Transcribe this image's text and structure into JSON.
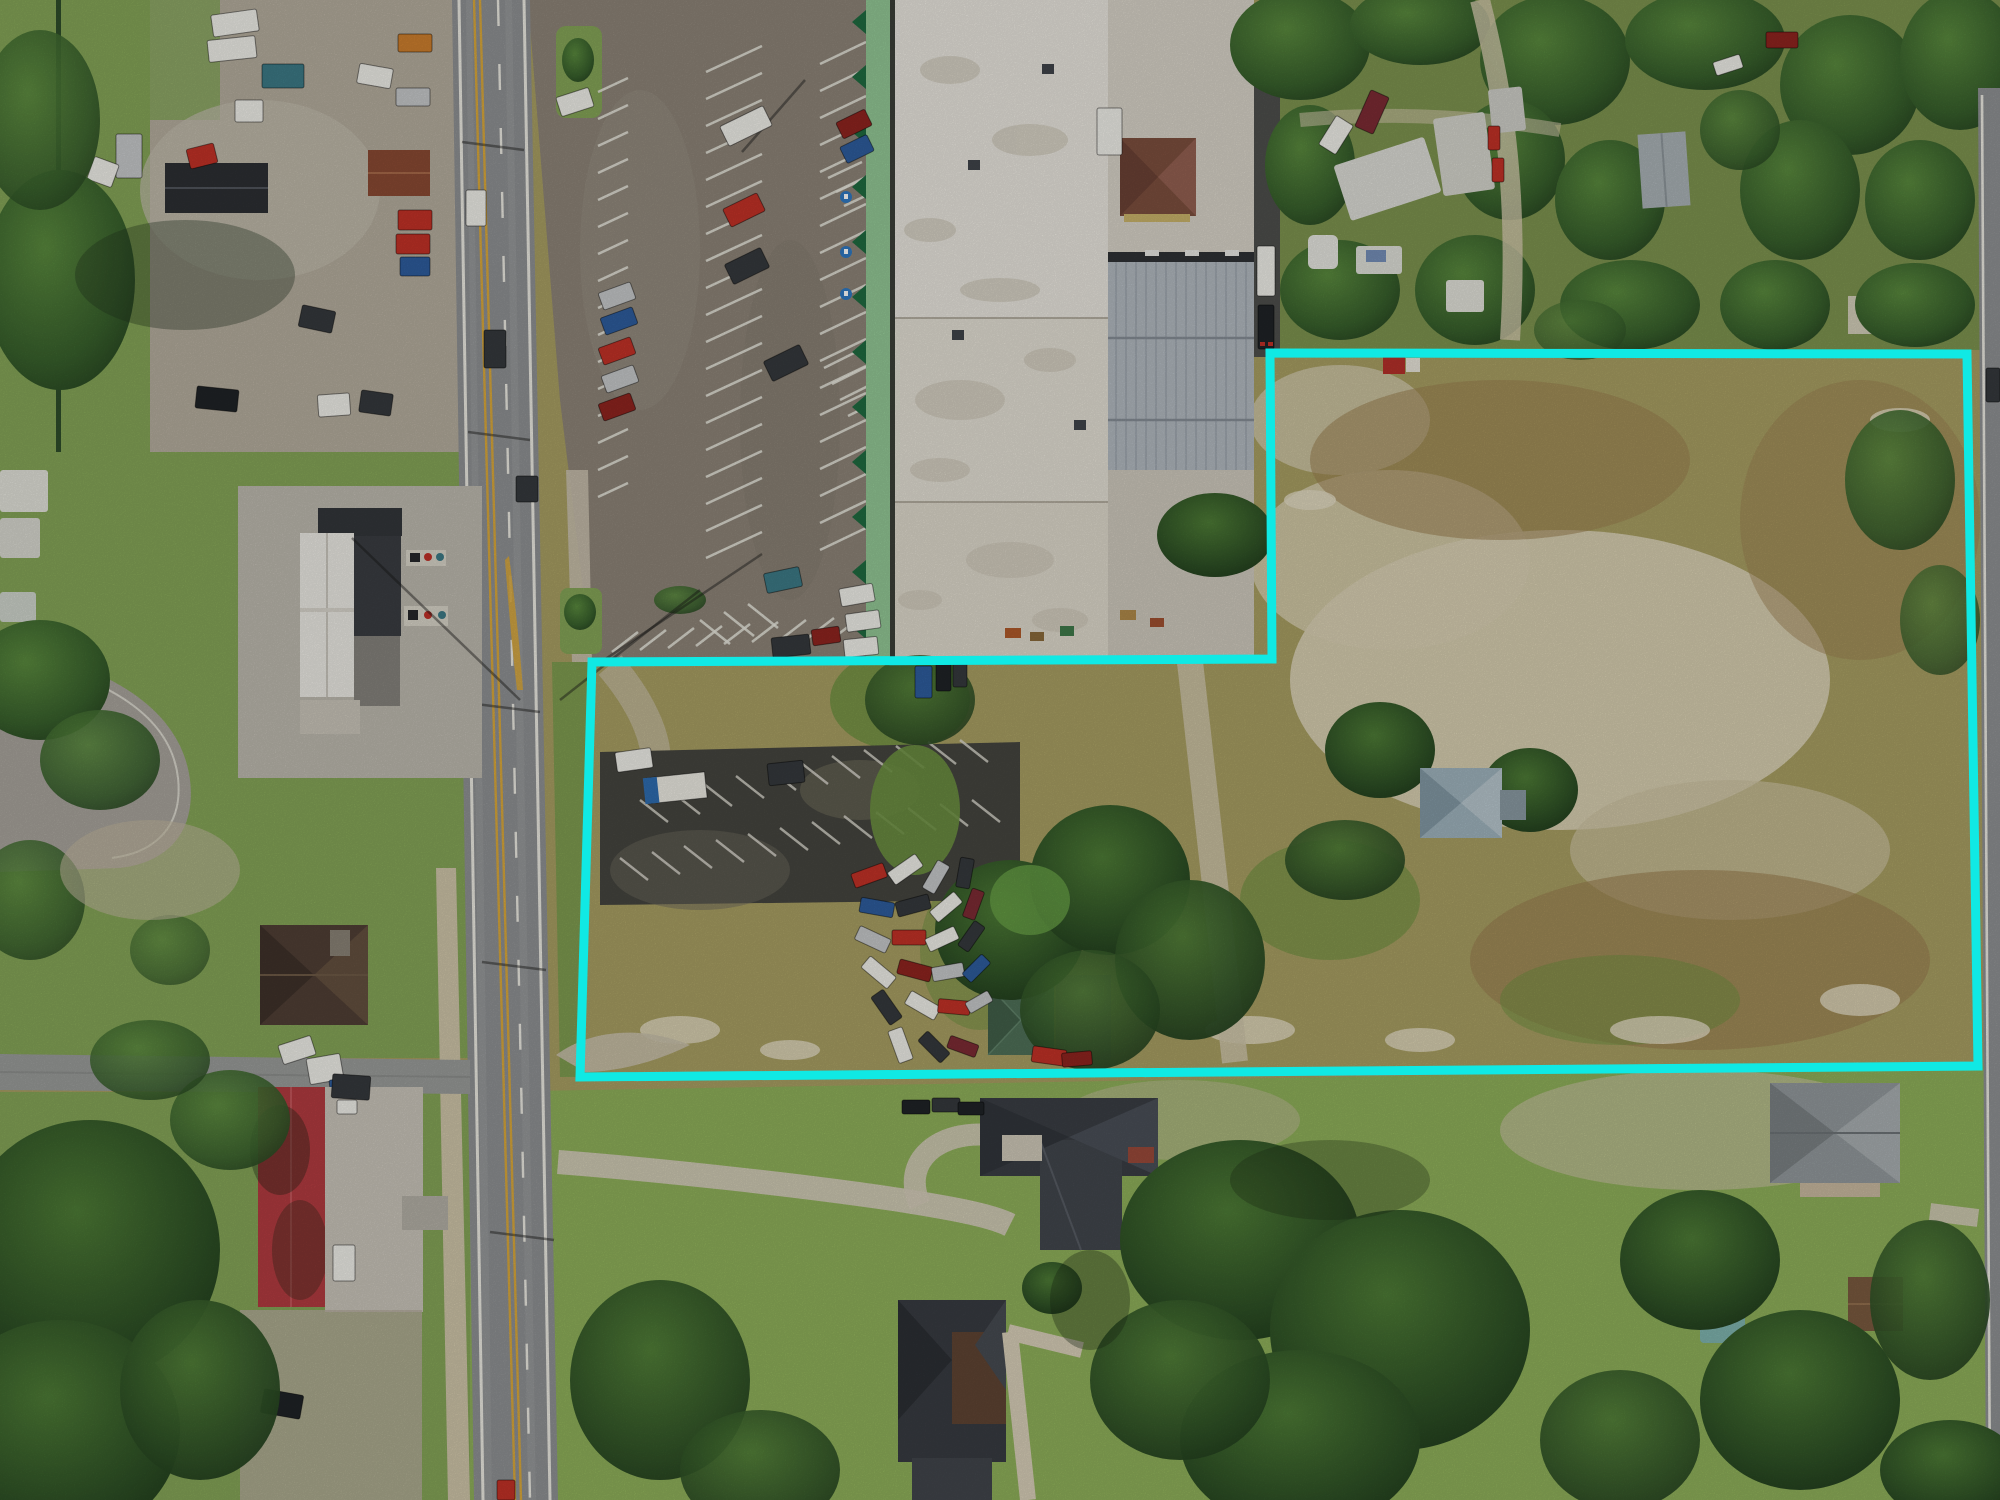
{
  "meta": {
    "kind": "aerial-drone-photograph",
    "description": "Overhead drone photo of a vacant commercial land parcel outlined with a cyan boundary, beside a strip-mall with white and metal roofs, an angled-stripe parking lot, a north-south highway with double yellow centerline, an auto salvage yard, a gas station canopy, mobile homes amid trees, and suburban houses with lawns and oak trees."
  },
  "overlay": {
    "name": "property-boundary",
    "color": "#10E9E4",
    "stroke_width": 9,
    "points": "592,662 1272,659 1270,353 1967,354 1978,1066 580,1077"
  },
  "palette": {
    "cyan": "#10E9E4",
    "road": "#8f9193",
    "sideRoad": "#9a9c9a",
    "lot": "#8d8478",
    "lotDark": "#45453f",
    "concrete": "#c6c1b5",
    "gravel": "#b5ad9e",
    "apron": "#bdb9af",
    "whiteRoof": "#e9e6de",
    "metalRoof": "#b2b9c0",
    "awning": "#92c795",
    "awningDark": "#1f6b40",
    "grass": "#85a557",
    "lawn": "#8fb05a",
    "verge": "#7f9c50",
    "scrub": "#a89f63",
    "brush": "#9b7f50",
    "sand": "#d9d1b4",
    "clump": "#6d9140",
    "treeDark": "#2f4d27",
    "treeMid": "#47703a",
    "treeLight": "#7fae4e",
    "redRoof": "#b23b40",
    "brownRoof": "#7c4f3e",
    "charcoalRoof": "#3a3e44",
    "grayRoof": "#92999c",
    "greenRoof": "#4f7058",
    "houseBrown": "#503f35",
    "blackRoof": "#2d2f33",
    "yellowLine": "#d9a83c",
    "whiteLine": "#eceae2",
    "alley": "#4e4f4c"
  }
}
